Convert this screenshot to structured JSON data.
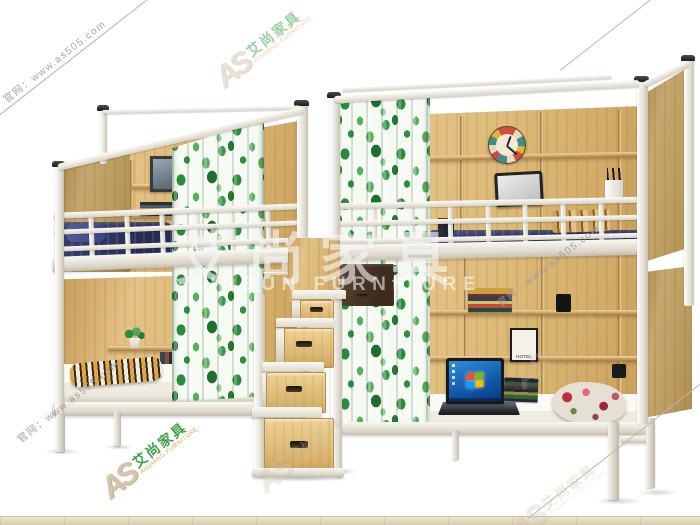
{
  "watermarks": {
    "site_label": "官网：www.as505.com",
    "brand_monogram": "AS",
    "brand_name_cn": "艾尚家具",
    "brand_name_en": "AISHANG FURNITURE",
    "center_title": "艾尚家具",
    "center_subtitle": "AIRSUN FURNITURE"
  },
  "scene": {
    "hotel_poster_label": "HOTEL"
  },
  "colors": {
    "wood": "#ddb97c",
    "wood_dark": "#c59b5a",
    "frame_white": "#f4f2ec",
    "curtain_green": "#2f9140",
    "bedding_navy": "#2c3272",
    "floor": "#d8cdb0",
    "watermark_gray": "#9a9a9a",
    "brand_green": "#3fa04a",
    "brand_orange": "#e2a24c",
    "brand_tan": "#d5c5ae",
    "laptop_screen_blue": "#1a6bc4",
    "win_red": "#f25022",
    "win_green": "#7fba00",
    "win_blue": "#00a4ef",
    "win_yellow": "#ffb900"
  }
}
